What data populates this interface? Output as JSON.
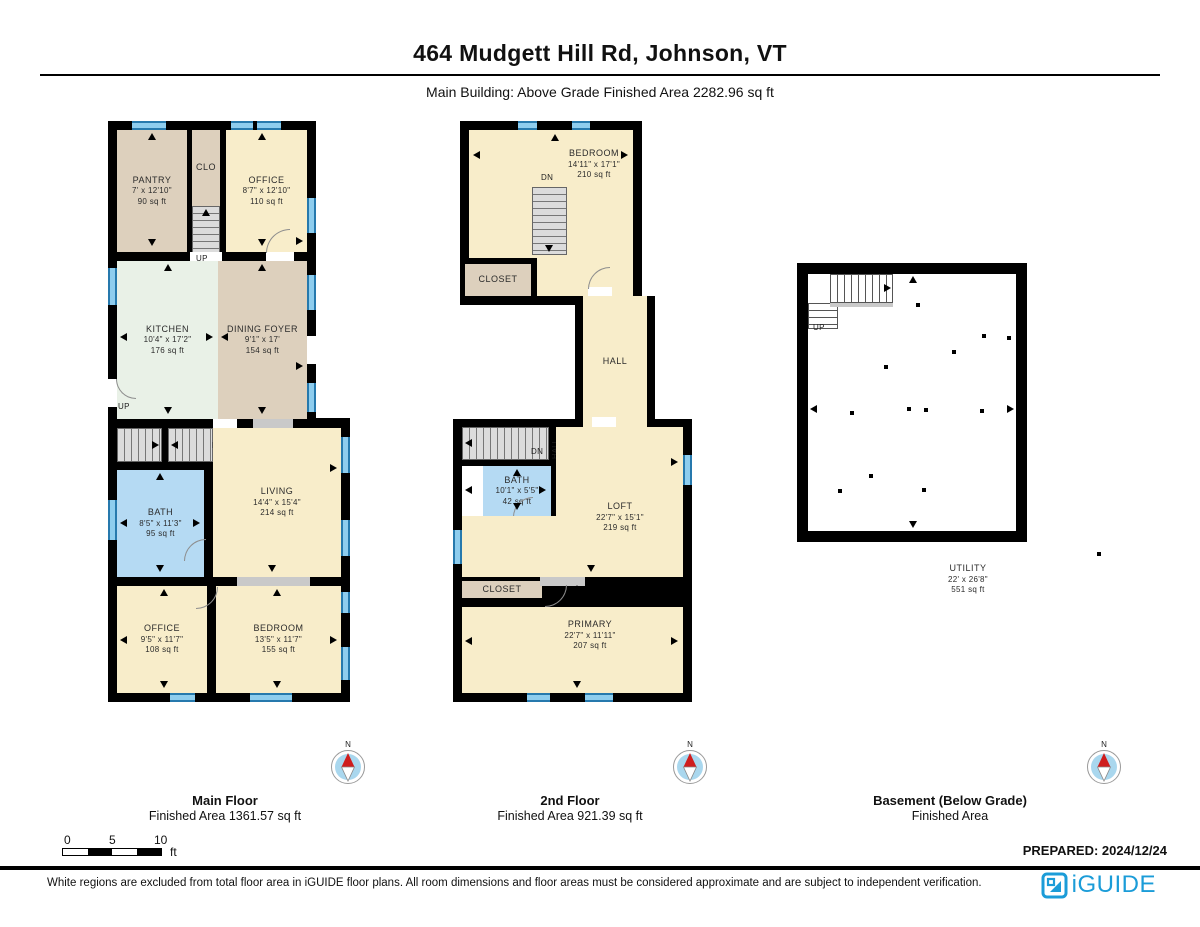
{
  "header": {
    "title": "464 Mudgett Hill Rd, Johnson, VT",
    "subtitle": "Main Building: Above Grade Finished Area 2282.96 sq ft"
  },
  "labels": {
    "up": "UP",
    "dn": "DN",
    "hall": "HALL",
    "closet": "CLOSET",
    "clo": "CLO",
    "north": "N"
  },
  "main_floor": {
    "title": "Main Floor",
    "subtitle": "Finished Area 1361.57 sq ft",
    "pantry": {
      "name": "PANTRY",
      "dims": "7' x 12'10\"",
      "area": "90 sq ft"
    },
    "office_top": {
      "name": "OFFICE",
      "dims": "8'7\" x 12'10\"",
      "area": "110 sq ft"
    },
    "kitchen": {
      "name": "KITCHEN",
      "dims": "10'4\" x 17'2\"",
      "area": "176 sq ft"
    },
    "dining_foyer": {
      "name": "DINING FOYER",
      "dims": "9'1\" x 17'",
      "area": "154 sq ft"
    },
    "bath": {
      "name": "BATH",
      "dims": "8'5\" x 11'3\"",
      "area": "95 sq ft"
    },
    "living": {
      "name": "LIVING",
      "dims": "14'4\" x 15'4\"",
      "area": "214 sq ft"
    },
    "office_bottom": {
      "name": "OFFICE",
      "dims": "9'5\" x 11'7\"",
      "area": "108 sq ft"
    },
    "bedroom": {
      "name": "BEDROOM",
      "dims": "13'5\" x 11'7\"",
      "area": "155 sq ft"
    }
  },
  "second_floor": {
    "title": "2nd Floor",
    "subtitle": "Finished Area 921.39 sq ft",
    "bedroom": {
      "name": "BEDROOM",
      "dims": "14'11\" x 17'1\"",
      "area": "210 sq ft"
    },
    "bath": {
      "name": "BATH",
      "dims": "10'1\" x 5'5\"",
      "area": "42 sq ft"
    },
    "loft": {
      "name": "LOFT",
      "dims": "22'7\" x 15'1\"",
      "area": "219 sq ft"
    },
    "primary": {
      "name": "PRIMARY",
      "dims": "22'7\" x 11'11\"",
      "area": "207 sq ft"
    }
  },
  "basement": {
    "title": "Basement (Below Grade)",
    "subtitle": "Finished Area",
    "utility": {
      "name": "UTILITY",
      "dims": "22' x 26'8\"",
      "area": "551 sq ft"
    }
  },
  "scale_bar": {
    "ticks": [
      "0",
      "5",
      "10"
    ],
    "unit": "ft"
  },
  "prepared": "PREPARED: 2024/12/24",
  "footer": {
    "disclaimer": "White regions are excluded from total floor area in iGUIDE floor plans. All room dimensions and floor areas must be considered approximate and are subject to independent verification.",
    "brand": "iGUIDE"
  },
  "colors": {
    "wall": "#000000",
    "window": "#8ecdee",
    "room_cream": "#f8edca",
    "room_tan": "#ddd0bd",
    "room_mint": "#e9f1e7",
    "room_blue": "#b5daf3",
    "stair_gray": "#dcdcdc",
    "compass_blue": "#a9d7ee",
    "needle_red": "#cf1d1d",
    "brand_blue": "#1b9cd8"
  }
}
